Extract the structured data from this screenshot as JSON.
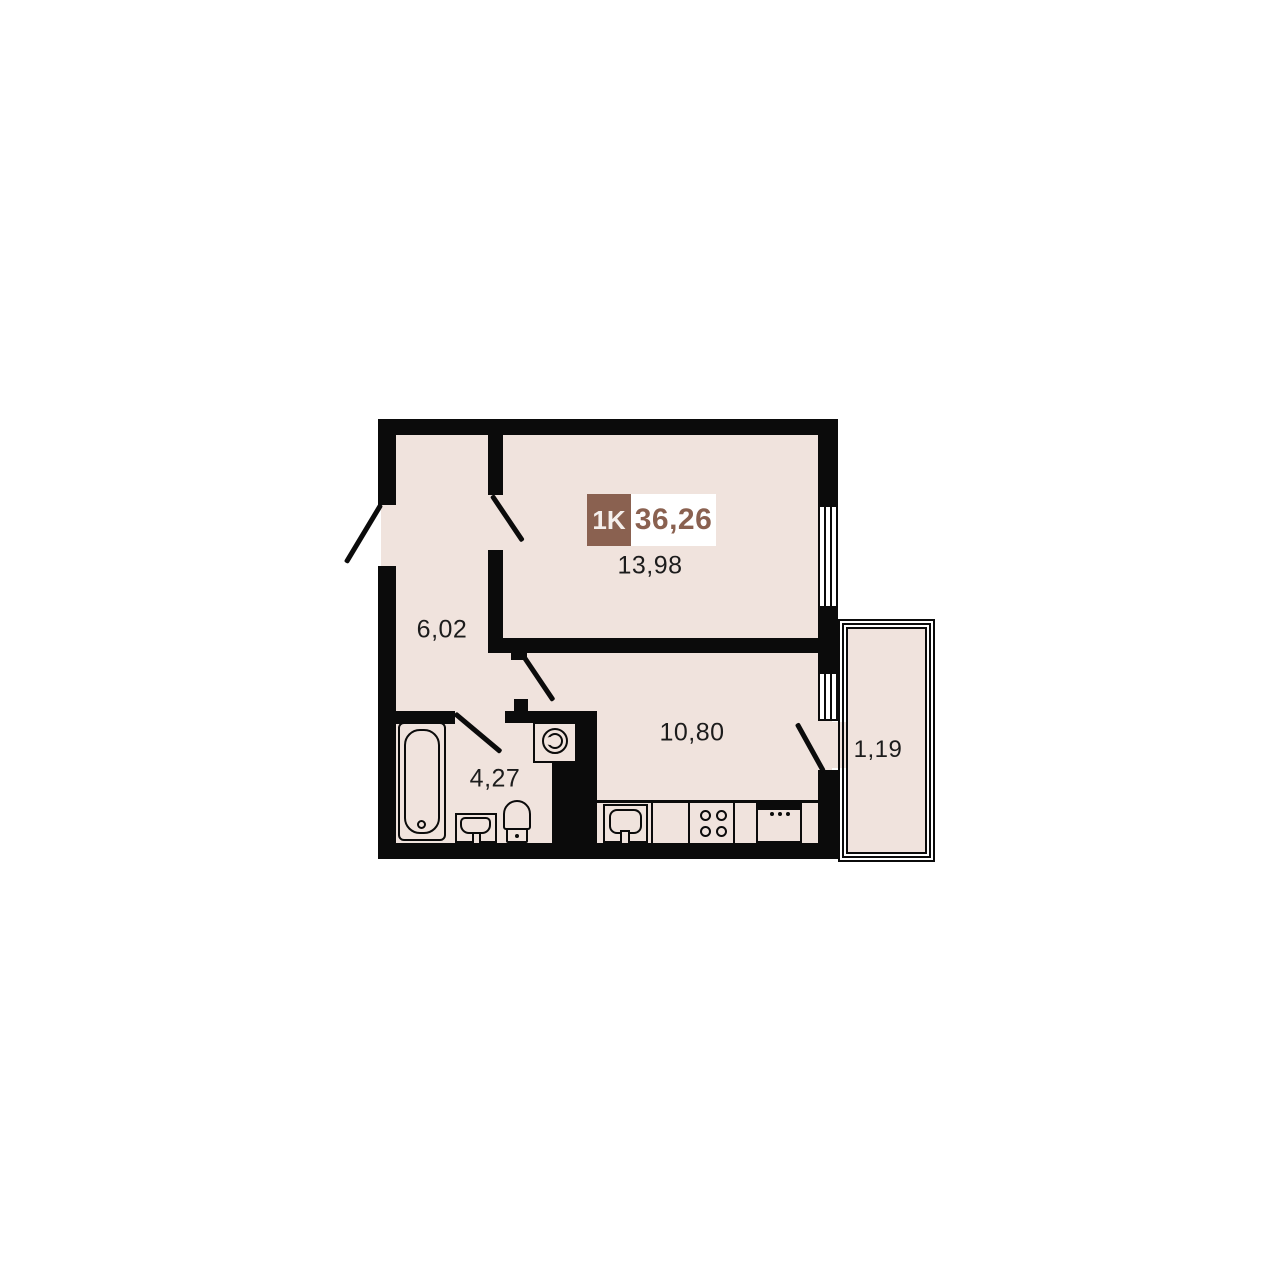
{
  "title": "Apartment floor plan",
  "badge": {
    "type": "1K",
    "total_area": "36,26"
  },
  "rooms": {
    "living": {
      "name": "living-room",
      "area": "13,98"
    },
    "hall": {
      "name": "hallway",
      "area": "6,02"
    },
    "kitchen": {
      "name": "kitchen",
      "area": "10,80"
    },
    "bathroom": {
      "name": "bathroom",
      "area": "4,27"
    },
    "balcony": {
      "name": "balcony",
      "area": "1,19"
    }
  },
  "fixtures": [
    "bathtub",
    "bathroom-sink",
    "toilet",
    "washing-machine",
    "kitchen-sink",
    "stove-4-burner",
    "kitchen-appliance"
  ],
  "windows": [
    "living-room-window",
    "kitchen-window"
  ],
  "doors": [
    "entrance-door",
    "living-room-door",
    "kitchen-door",
    "bathroom-door",
    "balcony-door"
  ],
  "colors": {
    "wall": "#0b0b0b",
    "floor": "#f0e3dd",
    "accent_brown": "#8a6150",
    "area_text": "#1c1c1c",
    "background": "#ffffff"
  }
}
